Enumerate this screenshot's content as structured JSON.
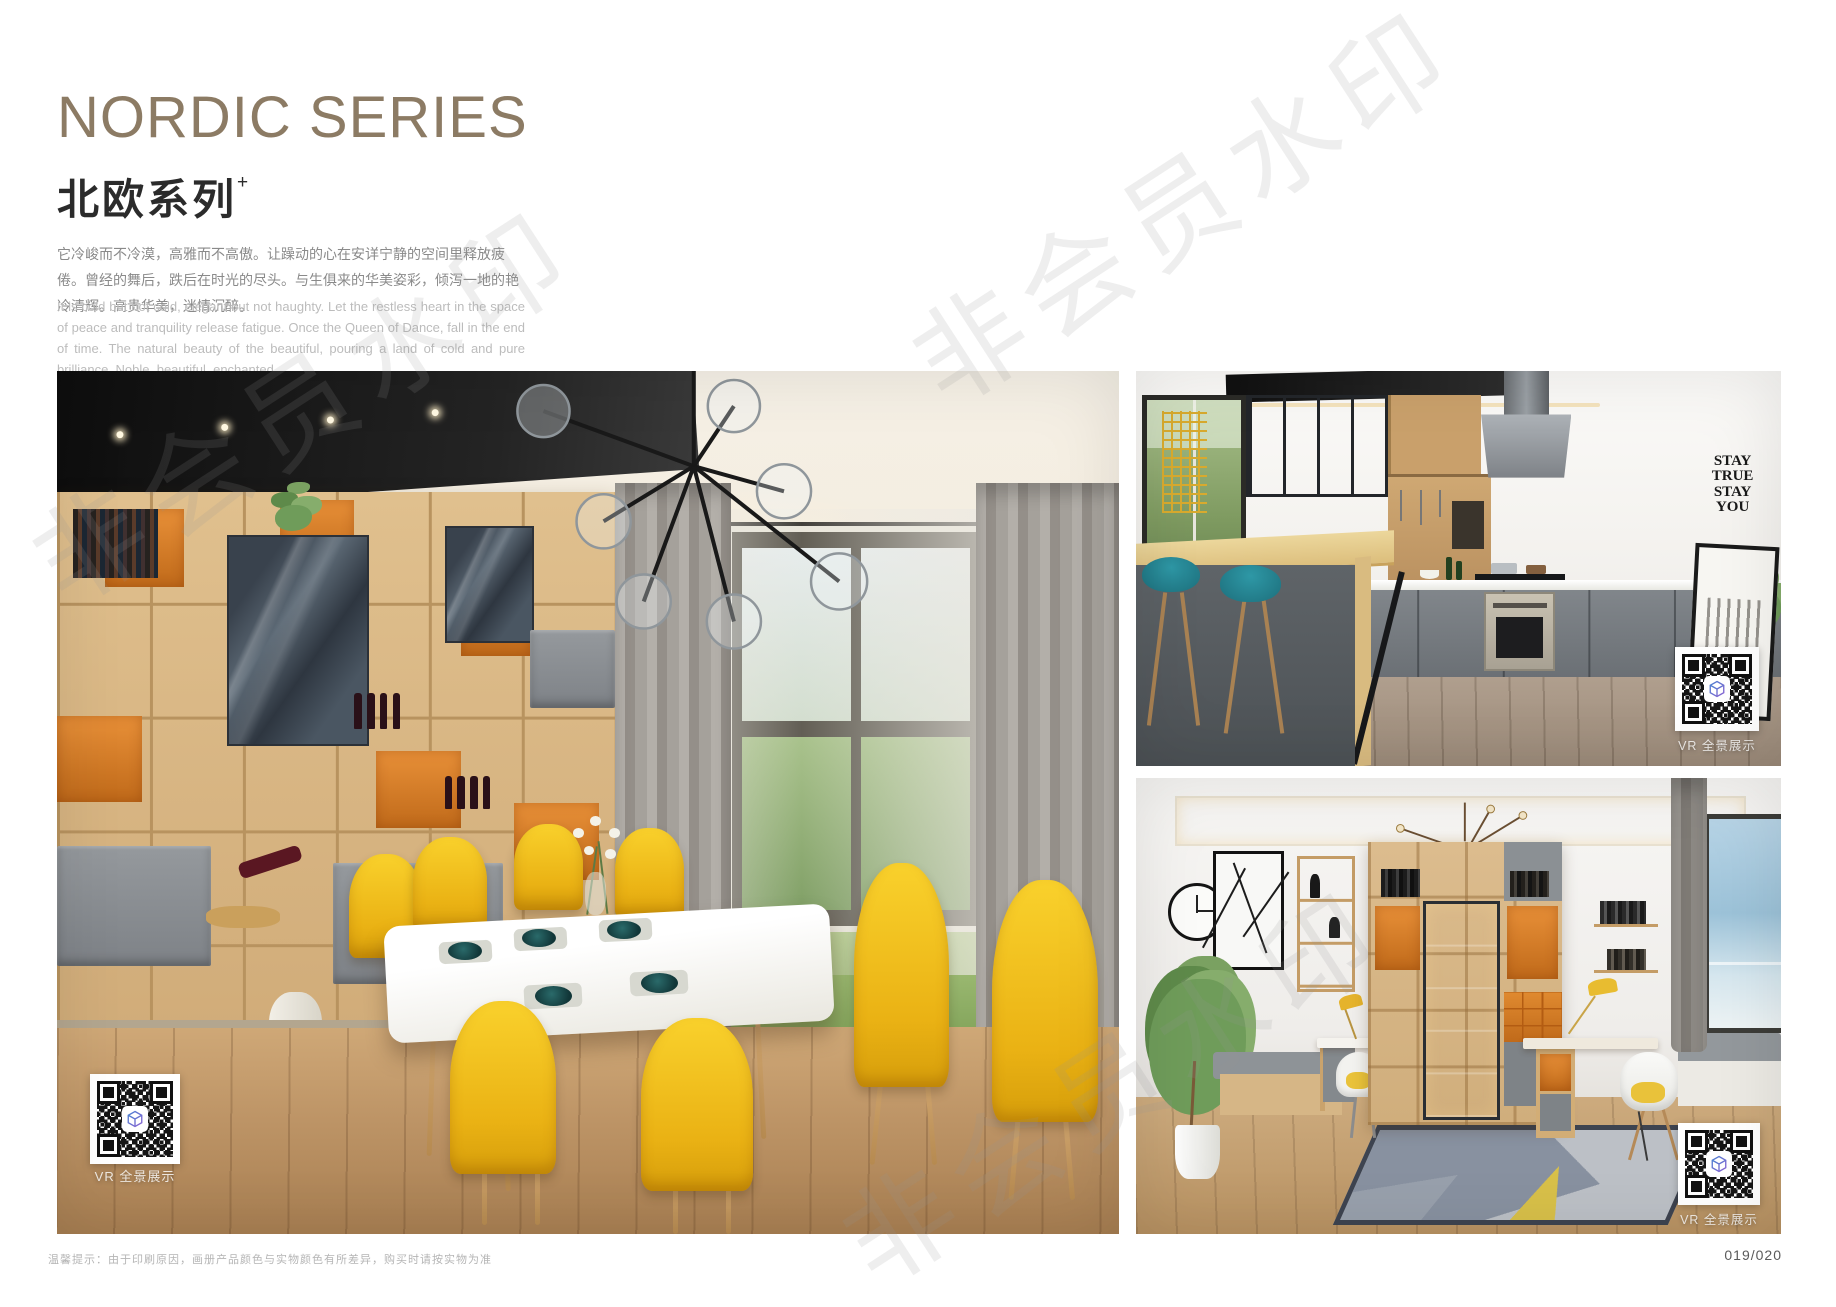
{
  "header": {
    "title_en": "NORDIC SERIES",
    "title_cn": "北欧系列",
    "title_sup": "+",
    "desc_cn": "它冷峻而不冷漠，高雅而不高傲。让躁动的心在安详宁静的空间里释放疲倦。曾经的舞后，跌后在时光的尽头。与生俱来的华美姿彩，倾泻一地的艳冷清辉。高贵华美，迷情沉醉。",
    "desc_en": "It is cold but not cold, elegant but not haughty. Let the restless heart in the space of peace and tranquility release fatigue. Once the Queen of Dance, fall in the end of time. The natural beauty of the beautiful, pouring a land of cold and pure brilliance. Noble, beautiful, enchanted."
  },
  "watermark": {
    "text": "非会员水印"
  },
  "photos": {
    "dining": {
      "vr_label": "VR 全景展示"
    },
    "kitchen": {
      "vr_label": "VR 全景展示",
      "wall_text": [
        "STAY",
        "TRUE",
        "STAY",
        "YOU"
      ]
    },
    "study": {
      "vr_label": "VR 全景展示"
    }
  },
  "footer": {
    "notice": "温馨提示：由于印刷原因，画册产品颜色与实物颜色有所差异，购买时请按实物为准",
    "page_number": "019/020"
  },
  "colors": {
    "title_brown": "#8c7b64",
    "accent_orange": "#d97b2c",
    "wood": "#d8b88a",
    "chair_yellow": "#f3c117",
    "stool_teal": "#1d6f7c",
    "qr_logo_blue": "#4b7fd0"
  },
  "icons": {
    "qr_logo": "cube-3d-icon"
  }
}
